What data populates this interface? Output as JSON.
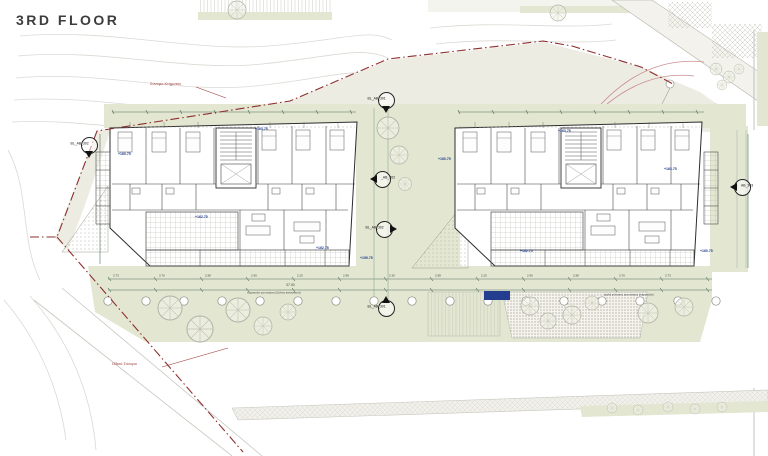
{
  "title": "3RD FLOOR",
  "boundary_labels": {
    "top": "Σύνορο Κτήματος",
    "bottom": "Οδικό Σύνορο"
  },
  "section_markers": [
    {
      "label": "BL_AB_301",
      "x": 385,
      "y": 99,
      "dir": "down",
      "side": "left"
    },
    {
      "label": "_AB_302",
      "x": 381,
      "y": 178,
      "dir": "left",
      "side": "right"
    },
    {
      "label": "BL_AB_302",
      "x": 383,
      "y": 228,
      "dir": "right",
      "side": "left"
    },
    {
      "label": "BL_AB_301",
      "x": 385,
      "y": 307,
      "dir": "up",
      "side": "left"
    },
    {
      "label": "BL_AB_302",
      "x": 88,
      "y": 144,
      "dir": "down",
      "side": "left"
    },
    {
      "label": "AB_303",
      "x": 741,
      "y": 186,
      "dir": "left",
      "side": "right"
    }
  ],
  "level_labels": [
    {
      "text": "+160.75",
      "x": 118,
      "y": 152
    },
    {
      "text": "+163.75",
      "x": 255,
      "y": 127
    },
    {
      "text": "+162.75",
      "x": 195,
      "y": 215
    },
    {
      "text": "+162.75",
      "x": 316,
      "y": 246
    },
    {
      "text": "+159.75",
      "x": 360,
      "y": 256
    },
    {
      "text": "+160.75",
      "x": 438,
      "y": 157
    },
    {
      "text": "+163.75",
      "x": 558,
      "y": 129
    },
    {
      "text": "+162.75",
      "x": 520,
      "y": 249
    },
    {
      "text": "+163.75",
      "x": 664,
      "y": 167
    },
    {
      "text": "+160.75",
      "x": 700,
      "y": 249
    }
  ],
  "dimensions": {
    "row_values": [
      "3.73",
      "3.70",
      "2.98",
      "2.90",
      "2.20",
      "2.98",
      "2.30",
      "2.98",
      "2.20",
      "2.90",
      "2.98",
      "3.70",
      "3.73"
    ],
    "total": "37.00"
  },
  "annotations": [
    {
      "text": "πέργκολα για σκίαση (ξύλινη κατασκευή)",
      "x": 247,
      "y": 291
    },
    {
      "text": "ψηλή φύτευση για σκίαση (πέργκολα)",
      "x": 604,
      "y": 293
    }
  ],
  "colors": {
    "boundary_red": "#8e2f2f",
    "level_blue": "#233e8f",
    "landscape_green": "#e3e6d1",
    "line_dark": "#2d2d2d"
  }
}
